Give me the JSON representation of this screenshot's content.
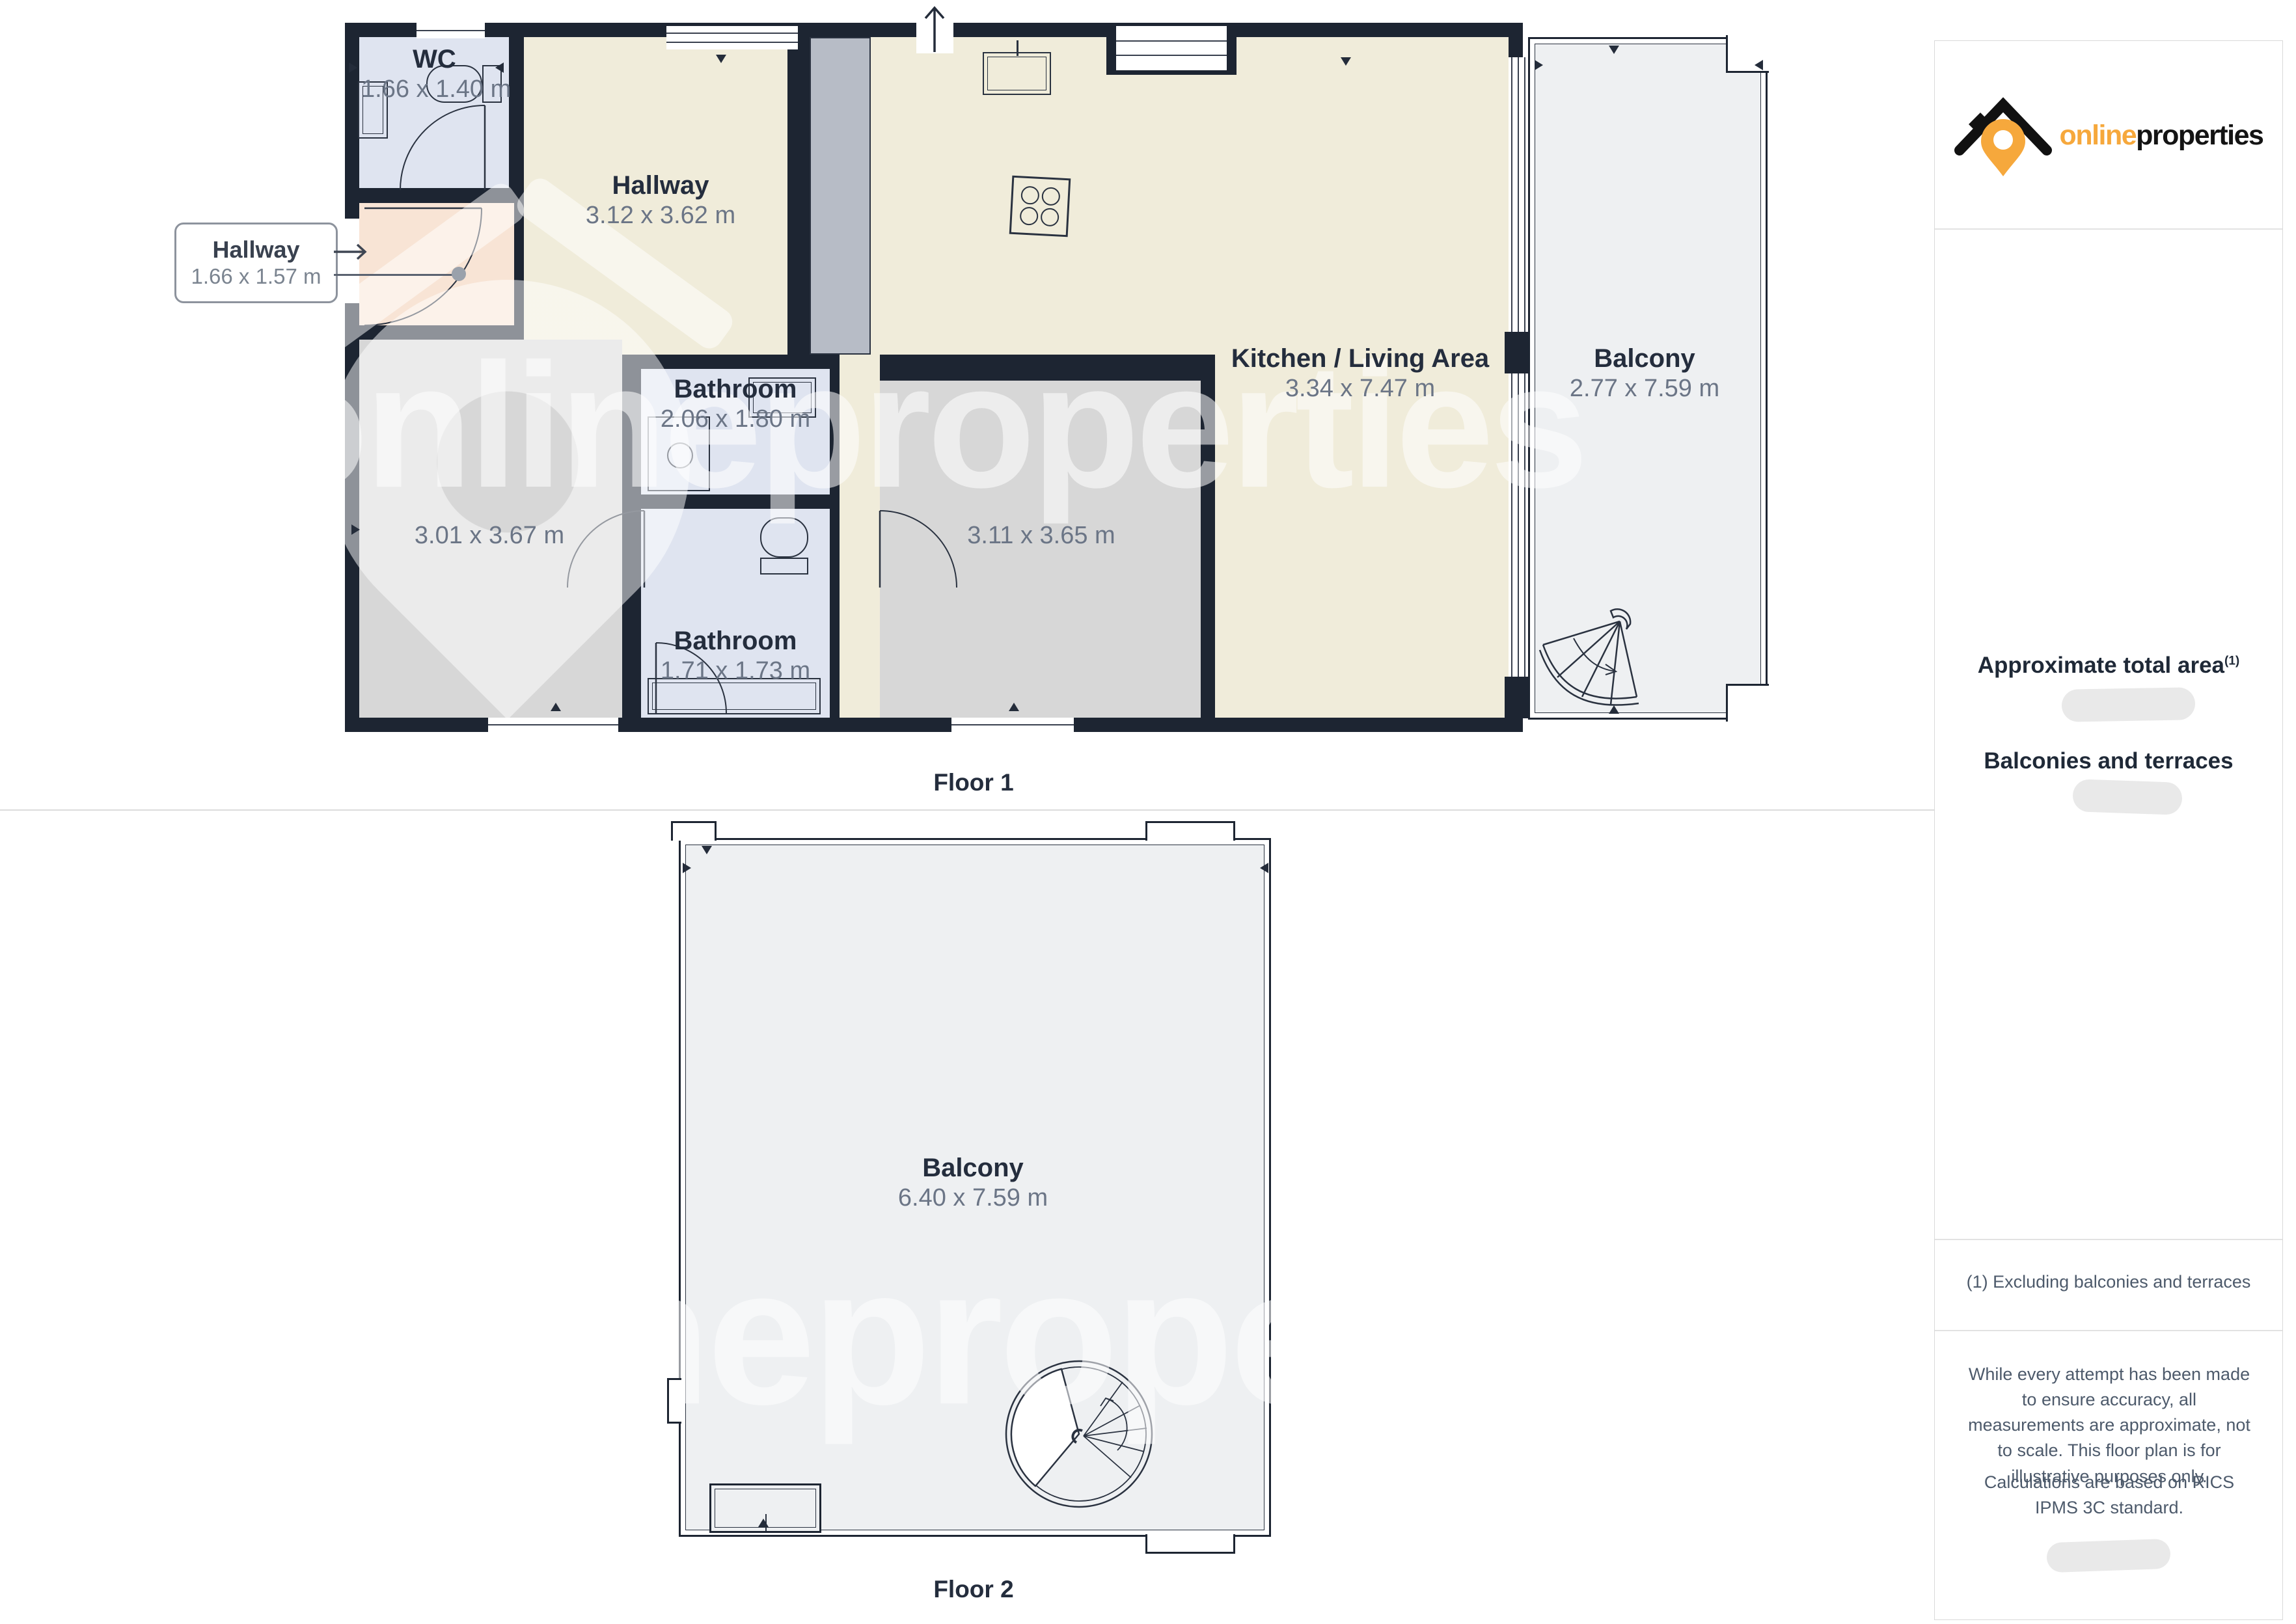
{
  "brand": {
    "online": "online",
    "properties": "properties"
  },
  "watermark_text": "onlineproperties",
  "sidebar": {
    "total_area_heading": "Approximate total area",
    "total_area_footnote_marker": "(1)",
    "balconies_heading": "Balconies and terraces",
    "footnote": "(1) Excluding balconies and terraces",
    "disclaimer_1": "While every attempt has been made to ensure accuracy, all measurements are approximate, not to scale. This floor plan is for illustrative purposes only.",
    "disclaimer_2": "Calculations are based on RICS IPMS 3C standard."
  },
  "floor1": {
    "caption": "Floor 1",
    "wc": {
      "name": "WC",
      "dims": "1.66 x 1.40 m"
    },
    "hallway": {
      "name": "Hallway",
      "dims": "3.12 x 3.62 m"
    },
    "kitchen_living": {
      "name": "Kitchen / Living Area",
      "dims": "3.34 x 7.47 m"
    },
    "balcony": {
      "name": "Balcony",
      "dims": "2.77 x 7.59 m"
    },
    "bathroom_top": {
      "name": "Bathroom",
      "dims": "2.06 x 1.80 m"
    },
    "bathroom_bottom": {
      "name": "Bathroom",
      "dims": "1.71 x 1.73 m"
    },
    "room_left": {
      "dims": "3.01 x 3.67 m"
    },
    "room_mid": {
      "dims": "3.11 x 3.65 m"
    },
    "callout": {
      "name": "Hallway",
      "dims": "1.66 x 1.57 m"
    }
  },
  "floor2": {
    "caption": "Floor 2",
    "balcony": {
      "name": "Balcony",
      "dims": "6.40 x 7.59 m"
    }
  },
  "icons": {
    "logo": "house-pin-logo",
    "stove": "stove-4-burner",
    "fan_stairs": "fan-staircase",
    "spiral_stairs": "spiral-staircase",
    "entrance": "entrance-arrow"
  },
  "colors": {
    "wall": "#1d2532",
    "cream": "#f0ecda",
    "gray_room": "#d7d7d7",
    "lavender": "#dfe4f0",
    "peach": "#f8e4d5",
    "balcony": "#eef0f2",
    "accent_orange": "#f6a83c",
    "label": "#242d3d",
    "dims": "#6b7586"
  }
}
